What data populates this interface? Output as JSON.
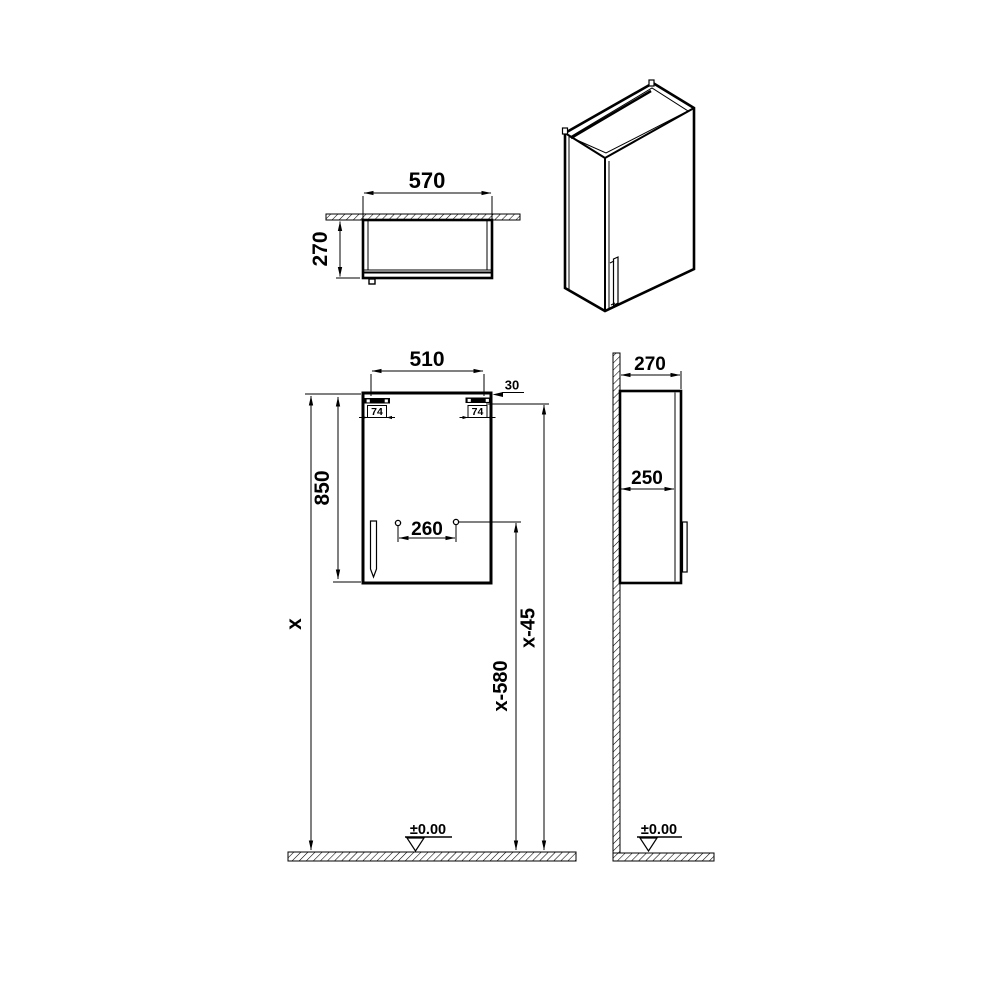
{
  "meta": {
    "title": "wall-cabinet-technical-drawing"
  },
  "colors": {
    "background": "#ffffff",
    "line": "#000000"
  },
  "labels": {
    "top_view": {
      "width": "570",
      "depth": "270"
    },
    "front_view": {
      "width": "510",
      "top_offset": "30",
      "bracket_left": "74",
      "bracket_right": "74",
      "height": "850",
      "hole_spacing": "260",
      "total_height": "x",
      "hole_height": "x-580",
      "bracket_height": "x-45",
      "datum": "±0.00"
    },
    "side_view": {
      "depth": "270",
      "inner_depth": "250",
      "datum": "±0.00"
    }
  }
}
